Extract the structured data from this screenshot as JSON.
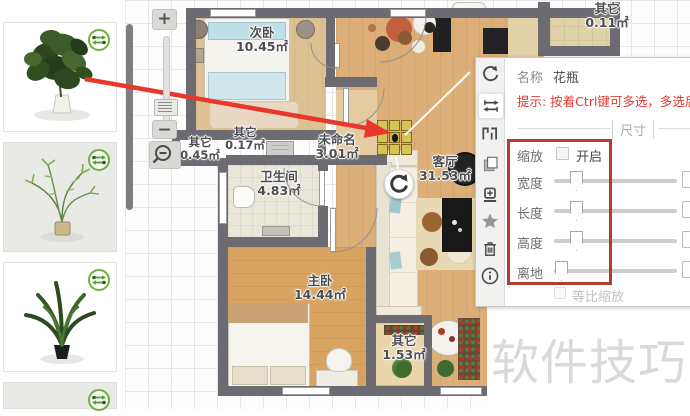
{
  "app": {
    "watermark": "软件技巧"
  },
  "sidebar": {
    "items": [
      {
        "id": "plant-ficus",
        "icon": "swap-arrows-icon"
      },
      {
        "id": "plant-hanging",
        "icon": "swap-arrows-icon"
      },
      {
        "id": "plant-palm",
        "icon": "swap-arrows-icon"
      },
      {
        "id": "plant-partial",
        "icon": "swap-arrows-icon"
      }
    ]
  },
  "canvas": {
    "zoom_controls": {
      "zoom_in": "+",
      "zoom_out": "−",
      "lens": "magnifier-minus-icon"
    },
    "rooms": [
      {
        "name": "次卧",
        "area": "10.45㎡"
      },
      {
        "name": "其它",
        "area": "0.45㎡"
      },
      {
        "name": "其它",
        "area": "0.17㎡"
      },
      {
        "name": "未命名",
        "area": "3.01㎡"
      },
      {
        "name": "卫生间",
        "area": "4.83㎡"
      },
      {
        "name": "客厅",
        "area": "31.53㎡"
      },
      {
        "name": "主卧",
        "area": "14.44㎡"
      },
      {
        "name": "其它",
        "area": "1.53㎡"
      },
      {
        "name": "其它",
        "area": "0.11㎡"
      }
    ]
  },
  "panel": {
    "name_label": "名称",
    "name_value": "花瓶",
    "hint": "提示: 按着Ctrl键可多选，多选后",
    "section_title": "尺寸",
    "scale_label": "缩放",
    "scale_toggle": "开启",
    "sliders": [
      {
        "label": "宽度"
      },
      {
        "label": "长度"
      },
      {
        "label": "高度"
      },
      {
        "label": "离地"
      }
    ],
    "proportional_label": "等比缩放",
    "toolbar_icons": [
      "rotate-icon",
      "flip-icon",
      "elevation-icon",
      "copy-icon",
      "move-icon",
      "star-icon",
      "trash-icon",
      "info-icon"
    ]
  },
  "colors": {
    "arrow_red": "#e8372b",
    "highlight_red": "#b23c34",
    "hint_red": "#e03a2e",
    "swap_green": "#6ab23e"
  }
}
